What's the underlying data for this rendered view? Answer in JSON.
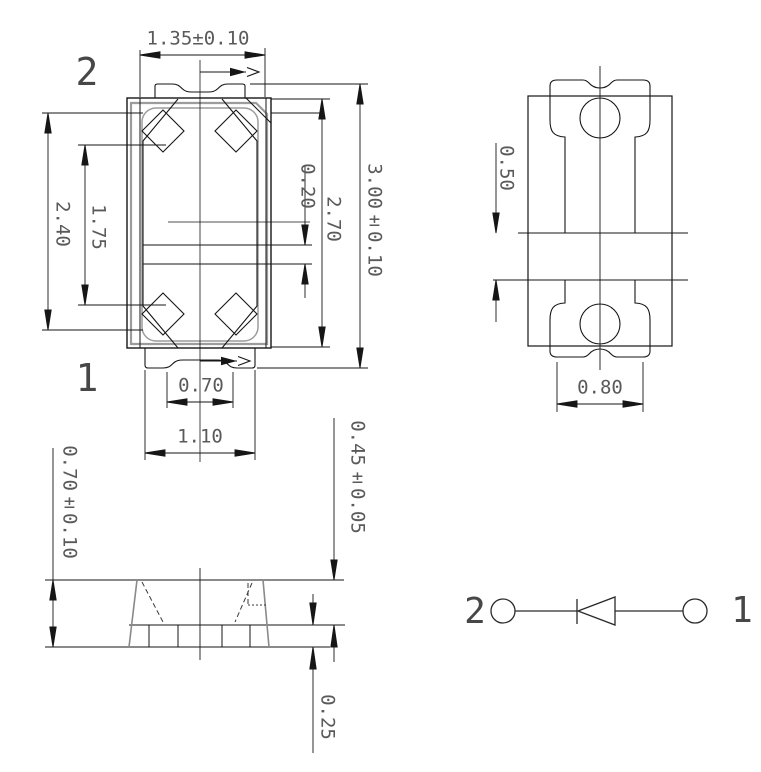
{
  "colors": {
    "background": "#ffffff",
    "line": "#161616",
    "gray_line": "#9c9c9c",
    "text": "#5a5a5a"
  },
  "top_view": {
    "pin_top": "2",
    "pin_bottom": "1",
    "dims": {
      "top_width": "1.35±0.10",
      "cavity_height": "2.40",
      "inner_pitch": "1.75",
      "electrode_gap": "0.20",
      "body_height": "2.70",
      "total_height": "3.00±0.10",
      "notch_width": "0.70",
      "tab_width": "1.10"
    }
  },
  "pad_layout": {
    "dims": {
      "pad_gap": "0.50",
      "pad_width": "0.80"
    }
  },
  "side_view": {
    "dims": {
      "total_height": "0.70±0.10",
      "upper_height": "0.45±0.05",
      "lead_height": "0.25"
    }
  },
  "schematic": {
    "pin_left": "2",
    "pin_right": "1"
  }
}
